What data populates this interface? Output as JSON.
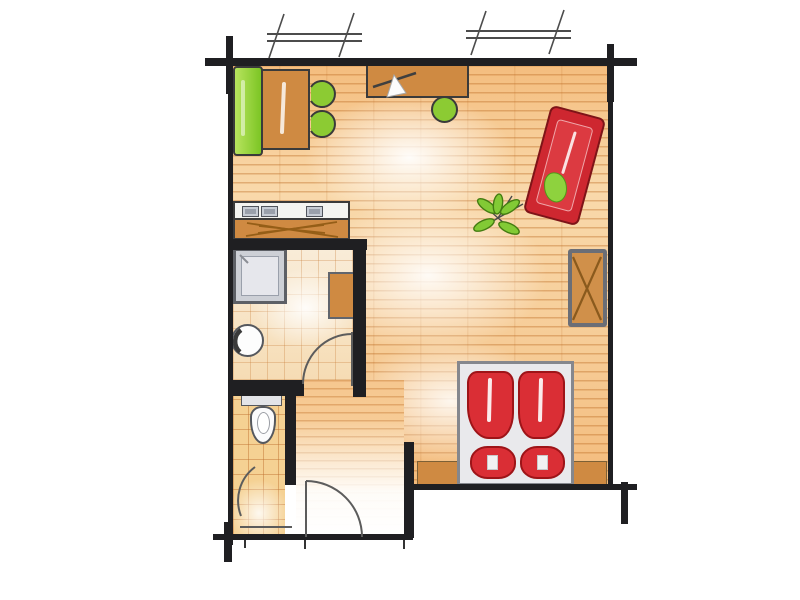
{
  "meta": {
    "title": "Hand-drawn studio apartment floor plan",
    "canvas": {
      "width": 800,
      "height": 600
    }
  },
  "palette": {
    "wall": "#1f1f22",
    "wood_floor_base": "#f6cb95",
    "plank_line": "#ba671e",
    "furniture_wood": "#cf8a42",
    "accent_green": "#8ccb33",
    "accent_red": "#d2272e",
    "tile_floor": "#f5d193",
    "fixture_gray": "#cdd0d6",
    "bed_frame": "#e9e9ec",
    "sketch_outline": "#3a3a3a"
  },
  "rooms": {
    "living": {
      "label": "Main living / sleeping area",
      "floor": "wood planks"
    },
    "bathroom": {
      "label": "Shower room",
      "floor": "tiles"
    },
    "wc": {
      "label": "WC",
      "floor": "tiles"
    },
    "hall": {
      "label": "Entry hall",
      "floor": "wood planks"
    }
  },
  "architecture": {
    "windows": {
      "count": 2,
      "wall": "top"
    },
    "doors": [
      {
        "name": "entrance-door",
        "wall": "bottom",
        "swing": "inward"
      },
      {
        "name": "bathroom-door",
        "wall": "bathroom bottom",
        "swing": "into bathroom"
      },
      {
        "name": "wc-door",
        "wall": "wc right",
        "swing": "into wc"
      }
    ]
  },
  "furniture": {
    "dining_bench": {
      "label": "Green bench",
      "color": "#8ccb33"
    },
    "dining_table": {
      "label": "Wooden dining table",
      "color": "#cf8a42"
    },
    "dining_chairs": {
      "label": "Green chairs",
      "count": 2,
      "color": "#8ccb33"
    },
    "desk": {
      "label": "Desk with lamp",
      "color": "#cf8a42"
    },
    "desk_stool": {
      "label": "Green stool",
      "color": "#8ccb33"
    },
    "kitchenette": {
      "label": "Kitchen counter with cooktop and sink",
      "appliance_modules": 3
    },
    "sofa": {
      "label": "Red sofa / daybed with green cushion",
      "color": "#d2272e",
      "rotation_deg": 15
    },
    "plant": {
      "label": "Floor plant",
      "color": "#82ca35"
    },
    "wardrobe": {
      "label": "Wardrobe with X front",
      "color": "#d0904a"
    },
    "shower": {
      "label": "Shower tray",
      "color": "#cdd0d6"
    },
    "washbasin": {
      "label": "Round washbasin"
    },
    "bath_cabinet": {
      "label": "Bathroom cabinet",
      "color": "#cf8a42"
    },
    "toilet": {
      "label": "Toilet with cistern"
    },
    "bed": {
      "label": "Double bed",
      "duvets": 2,
      "pillows": 2,
      "color": "#d2272e"
    },
    "sideboard": {
      "label": "Low sideboard at bed head",
      "color": "#cf8a42"
    }
  }
}
